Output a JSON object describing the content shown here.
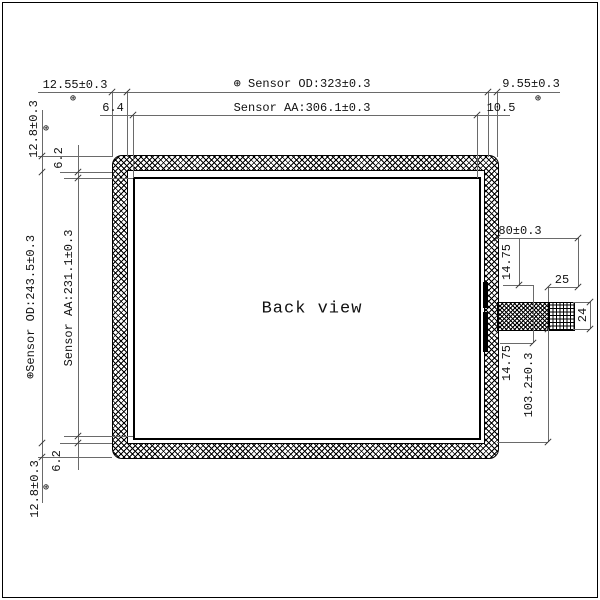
{
  "drawing": {
    "view_label": "Back view",
    "position_symbol": "⊕",
    "dimensions": {
      "top": {
        "od_left_margin": "12.55±0.3",
        "od": "⊕ Sensor OD:323±0.3",
        "od_right_margin": "9.55±0.3",
        "aa_left_margin": "6.4",
        "aa": "Sensor AA:306.1±0.3",
        "aa_right_margin": "10.5"
      },
      "left": {
        "top_margin": "12.8±0.3",
        "top_aa_gap": "6.2",
        "od": "⊕Sensor OD:243.5±0.3",
        "aa": "Sensor AA:231.1±0.3",
        "bottom_aa_gap": "6.2",
        "bottom_margin": "12.8±0.3"
      },
      "connector": {
        "tail_length": "80±0.3",
        "upper_offset": "14.75",
        "lower_offset": "14.75",
        "stiffener_width": "25",
        "stiffener_height": "24",
        "bottom_offset": "103.2±0.3"
      }
    }
  }
}
